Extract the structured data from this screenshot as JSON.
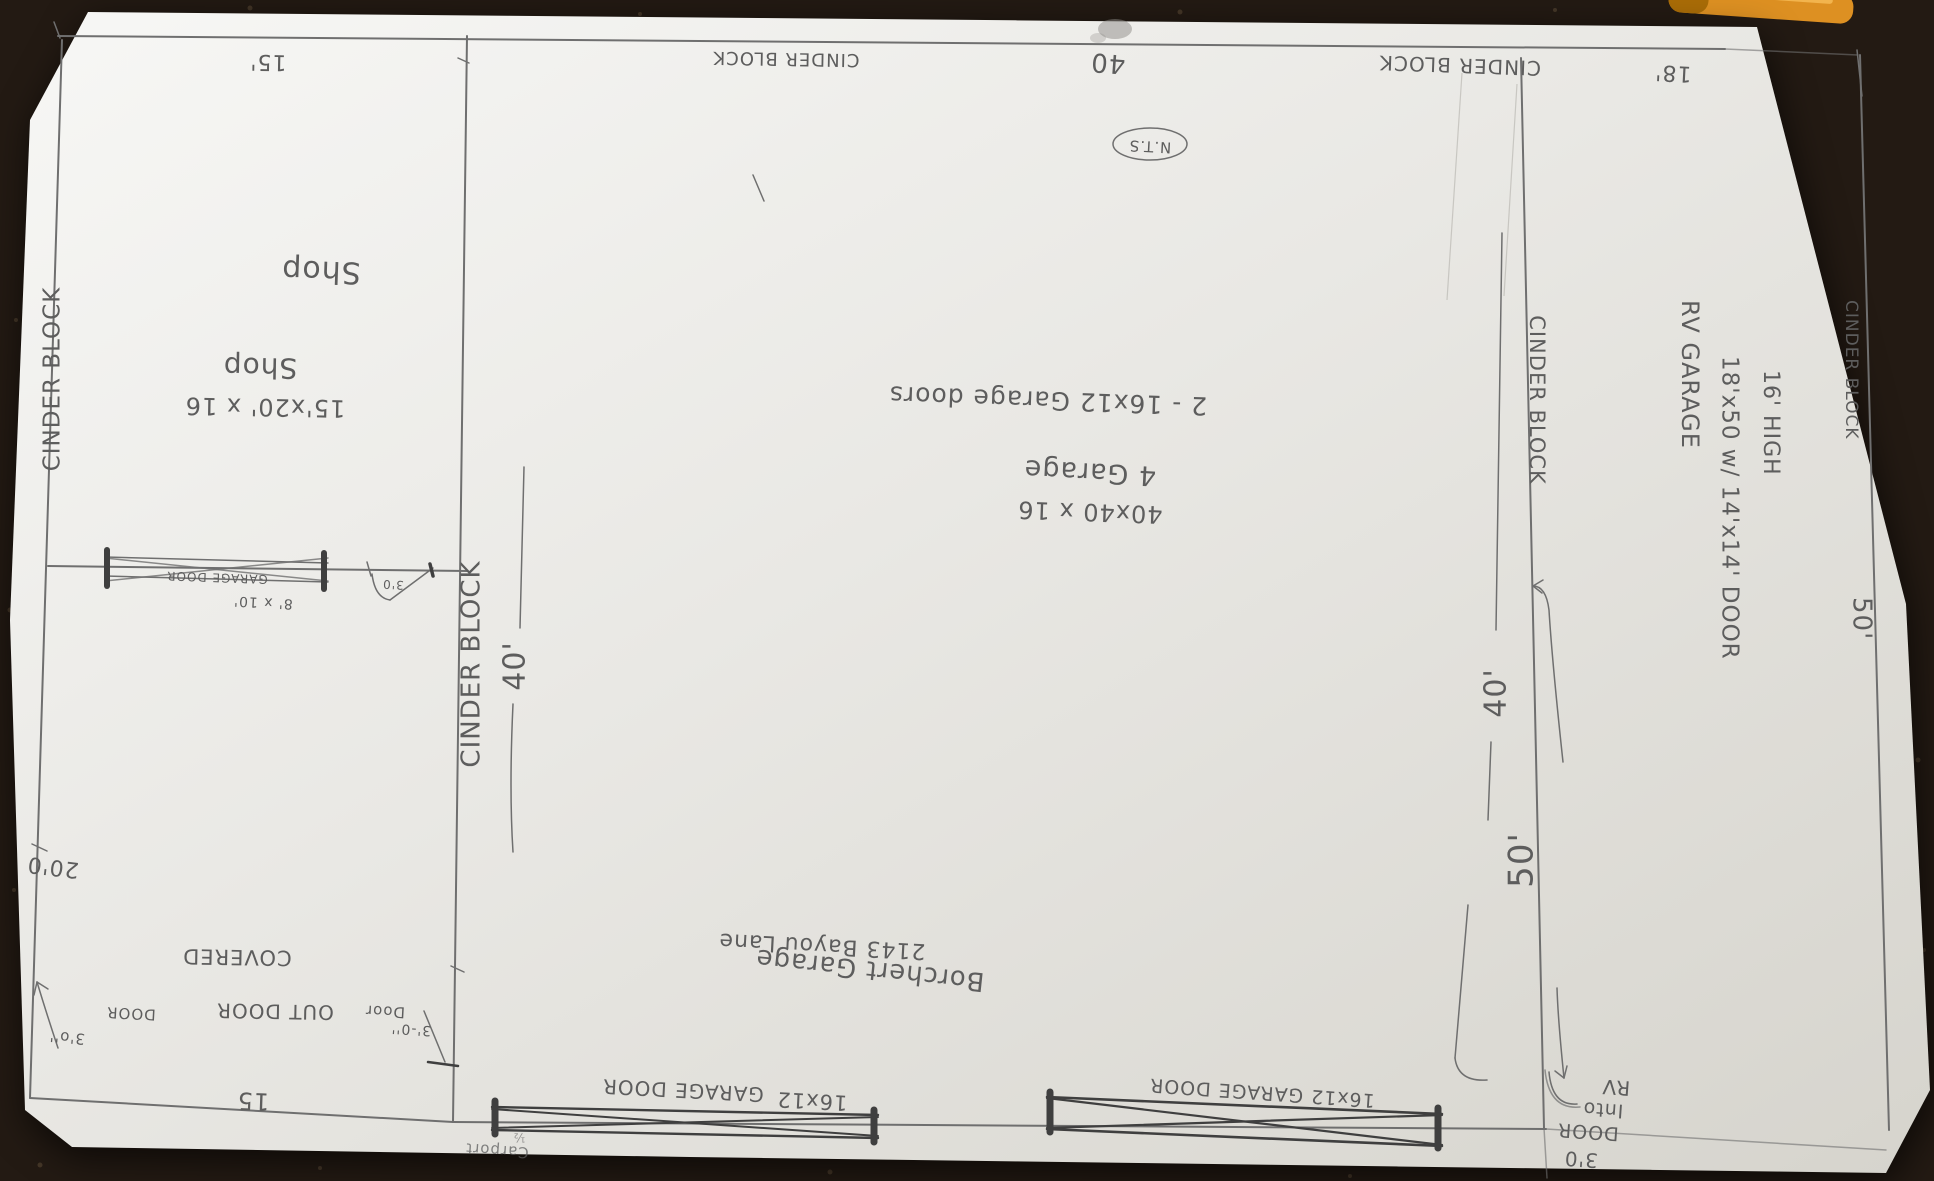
{
  "colors": {
    "background": "#231a13",
    "background_spot": "#57born",
    "speck": "#5a4936",
    "paper_light": "#f6f6f4",
    "paper_mid": "#e7e6e2",
    "paper_dark": "#d5d3cc",
    "pencil": "#6f6f6f",
    "pencil_dark": "#3f3f3f",
    "pencil_faint": "#a7a5a0",
    "pencil_text": "#5d5d5d",
    "smudge": "#8e8c88",
    "pen_orange": "#dd9022",
    "pen_orange_dark": "#a96c07",
    "pen_orange_light": "#f2b44d"
  },
  "sheet": {
    "top_edge": {
      "dim_left": "15'",
      "cinder_block_left": "CINDER BLOCK",
      "dim_mid": "40",
      "cinder_block_right": "CINDER BLOCK",
      "dim_right": "18'",
      "scale_note": "N.T.S"
    },
    "shop": {
      "label_a": "Shop",
      "label_b": "Shop",
      "size": "15'x20' x 16",
      "door_label": "GARAGE DOOR",
      "door_size": "8' x 10'",
      "side_door_size": "3'0"
    },
    "left_side": {
      "cinder_block": "CINDER BLOCK",
      "dim": "20'0"
    },
    "main_garage": {
      "doors_note": "2 - 16x12 Garage doors",
      "name": "4 Garage",
      "size": "40x40 x 16",
      "wall_label": "CINDER BLOCK",
      "depth_dim": "40'"
    },
    "carport": {
      "covered": "COVERED",
      "outdoor": "OUT DOOR",
      "width_dim": "15",
      "edge_door_label": "DOOR",
      "edge_door_size": "3'o''",
      "inner_door_label": "Door",
      "inner_door_size": "3'-0''",
      "name": "Carport",
      "tick_note": "½"
    },
    "street_side": {
      "owner": "Borchert Garage",
      "address": "2143 Bayou Lane",
      "door1_size": "16x12",
      "door1_label": "GARAGE DOOR",
      "door2_label": "16x12 GARAGE DOOR"
    },
    "right_side": {
      "wall_label": "CINDER BLOCK",
      "dim_40": "40'",
      "dim_50": "50'",
      "rv_title": "RV GARAGE",
      "rv_size": "18'x50 w/ 14'x14' DOOR",
      "rv_height": "16' HIGH",
      "edge_label": "CINDER BLOCK",
      "edge_dim": "50'",
      "rv_door_size": "3'0",
      "rv_door_l1": "DOOR",
      "rv_door_l2": "Into",
      "rv_door_l3": "RV"
    }
  }
}
